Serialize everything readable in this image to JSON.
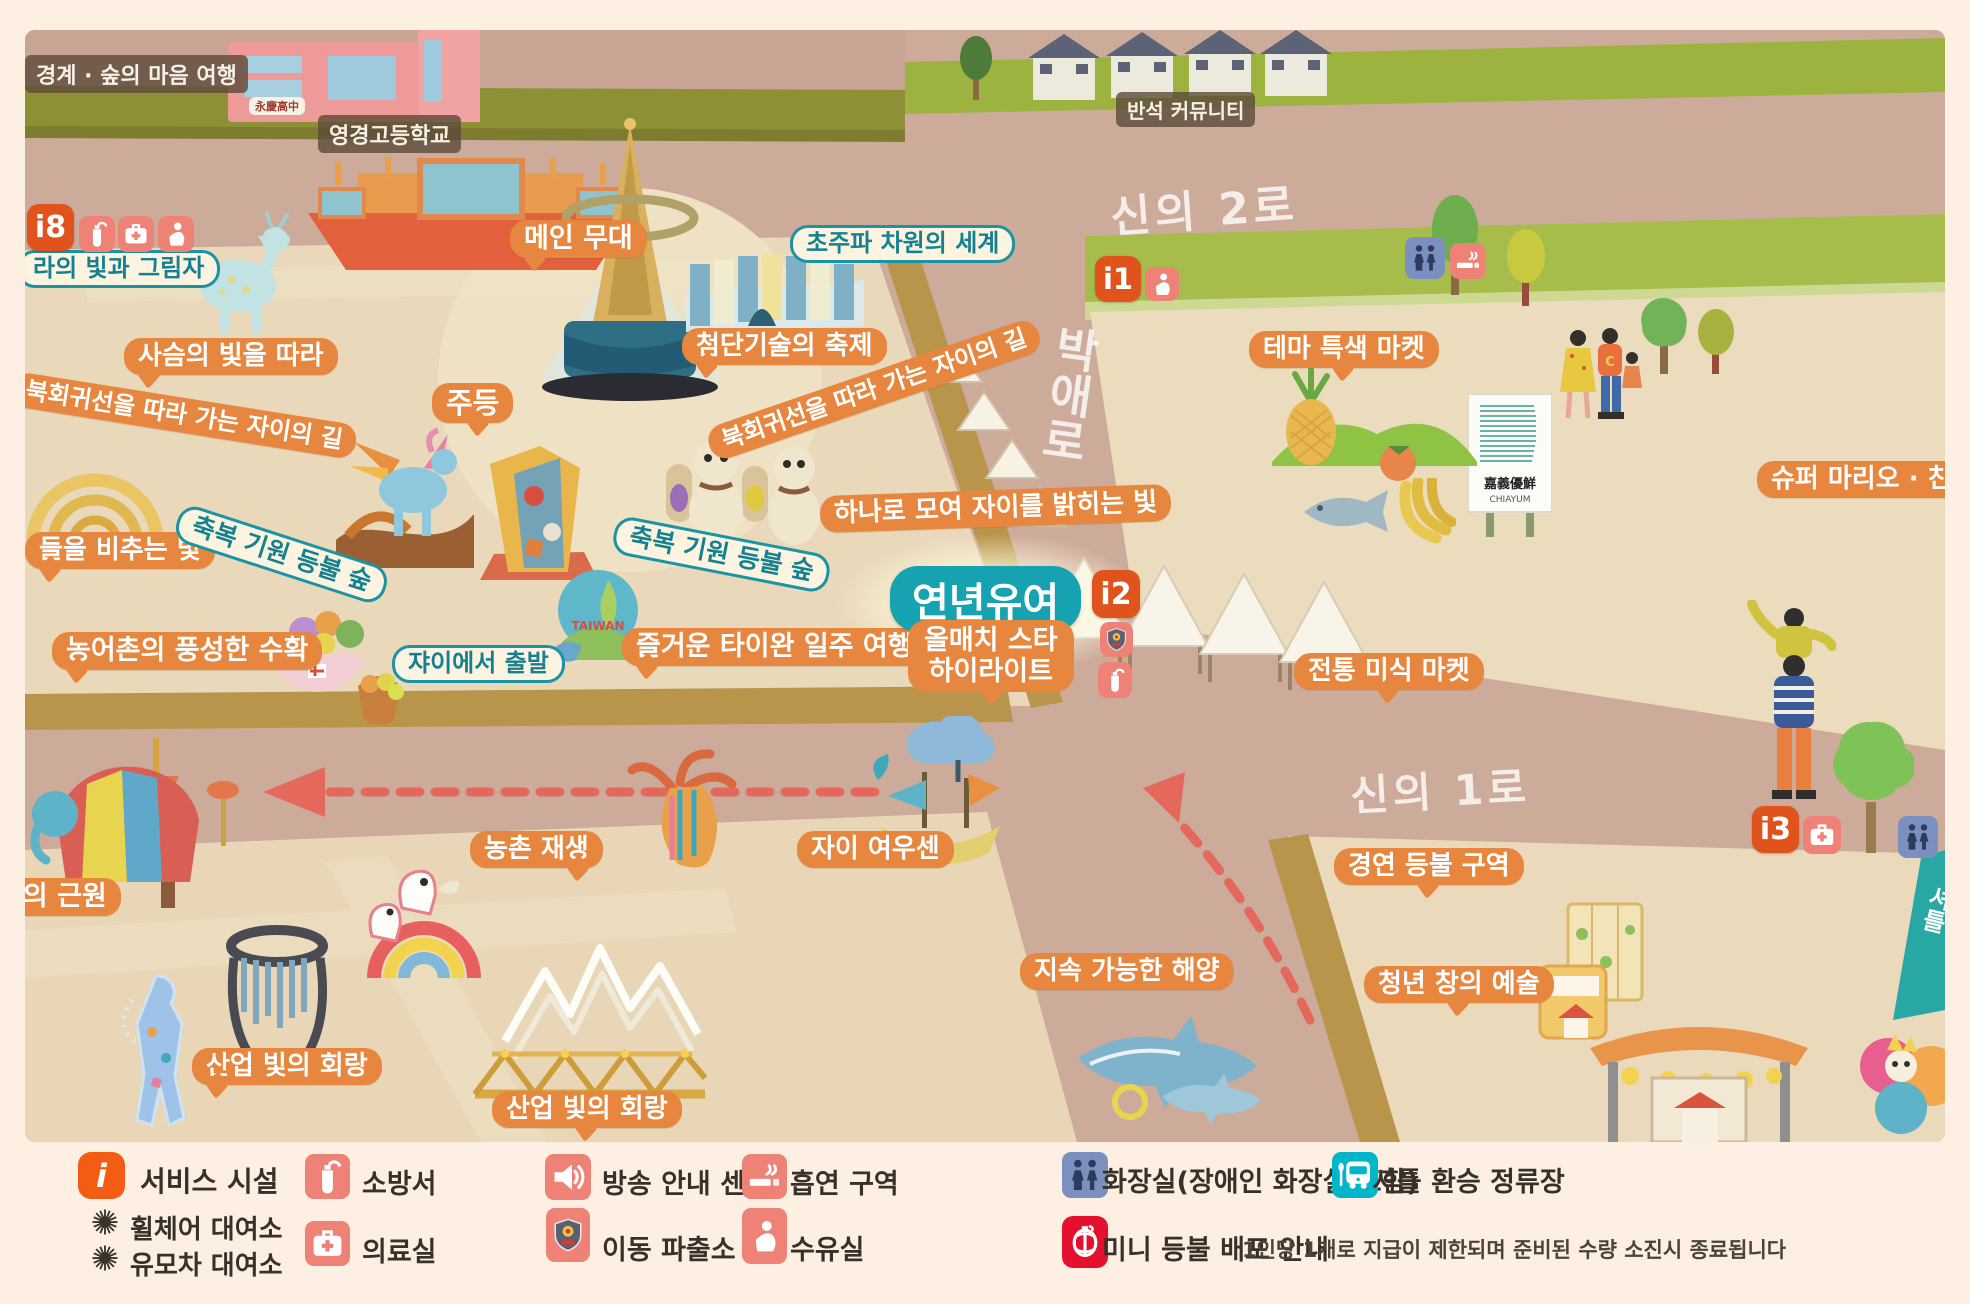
{
  "colors": {
    "page_bg": "#fdf0e2",
    "orange_label": "#e7863f",
    "teal_label": "#1a93a3",
    "teal_solid": "#17a2b2",
    "badge_orange": "#e0531d",
    "coral_icon": "#ef8276",
    "blue_icon": "#7b90bf",
    "teal_icon": "#00b6c8",
    "red_icon": "#e50f2e",
    "legend_orange": "#f25c13"
  },
  "map": {
    "places": {
      "border_trip": "경계 · 숲의 마음 여행",
      "school": "영경고등학교",
      "school_sign": "永慶高中",
      "community": "반석 커뮤니티"
    },
    "roads": {
      "shinui2": "신의 2로",
      "shinui1": "신의 1로",
      "bakae": "박애로"
    },
    "badges": {
      "b8": "i8",
      "b1": "i1",
      "b2": "i2",
      "b3": "i3"
    },
    "highlight": {
      "title": "연년유여",
      "sub1": "올매치 스타",
      "sub2": "하이라이트"
    },
    "orange_labels": [
      {
        "text": "메인 무대"
      },
      {
        "text": "주등"
      },
      {
        "text": "첨단기술의 축제"
      },
      {
        "text": "사슴의 빛을 따라"
      },
      {
        "text": "북회귀선을 따라 가는 자이의 길"
      },
      {
        "text": "북회귀선을 따라 가는 자이의 길"
      },
      {
        "text": "하나로 모여 자이를 밝히는 빛"
      },
      {
        "text": "즐거운 타이완 일주 여행"
      },
      {
        "text": "농어촌의 풍성한 수확"
      },
      {
        "text": "들을 비추는 빛"
      },
      {
        "text": "명의 근원"
      },
      {
        "text": "농촌 재생"
      },
      {
        "text": "산업 빛의 회랑"
      },
      {
        "text": "산업 빛의 회랑"
      },
      {
        "text": "자이 여우센"
      },
      {
        "text": "지속 가능한 해양"
      },
      {
        "text": "테마 특색 마켓"
      },
      {
        "text": "전통 미식 마켓"
      },
      {
        "text": "슈퍼 마리오 · 친"
      },
      {
        "text": "경연 등불 구역"
      },
      {
        "text": "청년 창의 예술"
      }
    ],
    "teal_labels": [
      {
        "text": "라의 빛과 그림자"
      },
      {
        "text": "초주파 차원의 세계"
      },
      {
        "text": "축복 기원 등불 숲"
      },
      {
        "text": "축복 기원 등불 숲"
      },
      {
        "text": "쟈이에서 출발"
      }
    ],
    "sign": {
      "cn": "嘉義優鮮",
      "en": "CHIAYUM"
    },
    "art_text": {
      "taiwan": "TAIWAN"
    },
    "corner": "셔틀"
  },
  "legend": {
    "service": {
      "icon_label": "i",
      "label": "서비스 시설",
      "sub": [
        {
          "label": "휠체어 대여소"
        },
        {
          "label": "유모차 대여소"
        }
      ]
    },
    "fire_station": "소방서",
    "medical_room": "의료실",
    "broadcast": "방송 안내 센터",
    "police_box": "이동 파출소",
    "smoking_area": "흡연 구역",
    "nursing_room": "수유실",
    "toilet": "화장실(장애인 화장실 포함)",
    "shuttle": "셔틀 환승 정류장",
    "mini_lantern": {
      "label": "미니 등불 배포 안내",
      "note": "1인당 1개로 지급이 제한되며 준비된 수량 소진시 종료됩니다"
    }
  }
}
